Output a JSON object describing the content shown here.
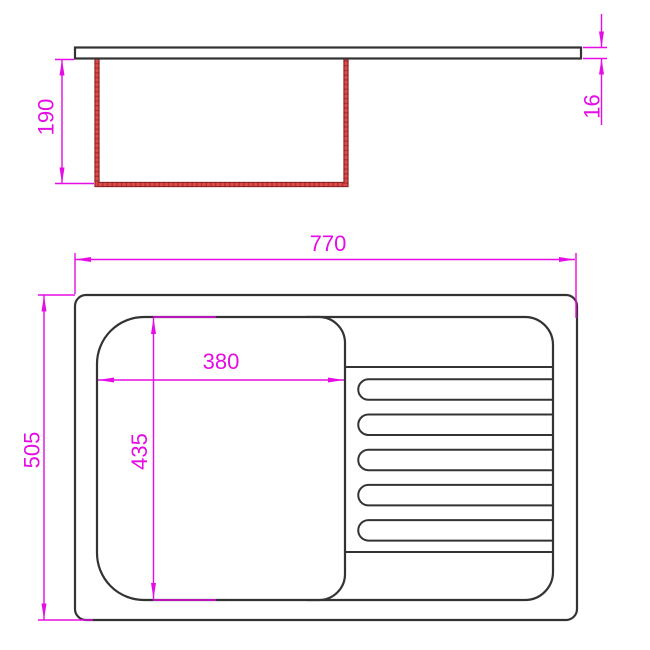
{
  "dimensions": {
    "bowl_depth": "190",
    "countertop_thickness": "16",
    "overall_width": "770",
    "overall_depth": "505",
    "bowl_width": "380",
    "bowl_length": "435"
  },
  "colors": {
    "dimension": "#e50ce5",
    "outline": "#333333",
    "bowl_red": "#df4b4b",
    "bowl_red_dark": "#8c2222",
    "background": "#ffffff"
  }
}
